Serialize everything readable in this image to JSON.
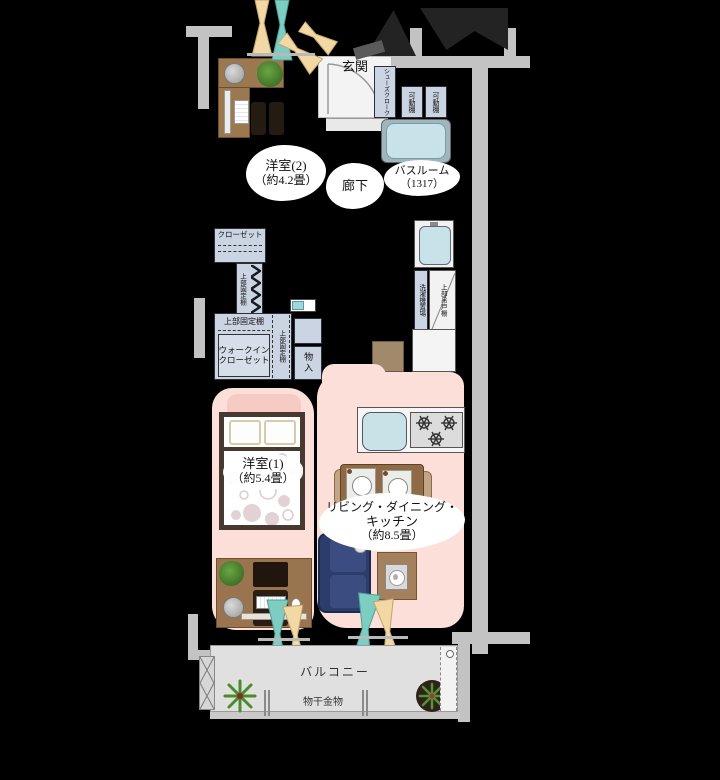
{
  "palette": {
    "background": "#000000",
    "wall_gray": "#C3C3C3",
    "floor_pink": "#FBDFD8",
    "balcony_gray": "#E0E0E0",
    "shelf_blue": "#CBD4E2",
    "bath_blue": "#C7E2E8",
    "wood_brown": "#9C7850",
    "sofa_navy": "#2C3C6C",
    "curtain_beige": "#F2D8A4",
    "curtain_teal": "#7ECDC3",
    "plant_green": "#4C8B2B"
  },
  "labels": {
    "genkan": "玄関",
    "shoes_cloak": "シューズクローク",
    "movable_shelf_1": "可動棚",
    "movable_shelf_2": "可動棚",
    "bathroom": "バスルーム",
    "bathroom_size": "（1317）",
    "western_room_2": "洋室(2)",
    "western_room_2_size": "（約4.2畳）",
    "hallway": "廊下",
    "closet": "クローゼット",
    "upper_fixed_shelf_closet": "上部固定棚",
    "upper_fixed_shelf_wic_top": "上部固定棚",
    "upper_fixed_shelf_wic_side": "上部固定棚",
    "walk_in_closet_line1": "ウォークイン",
    "walk_in_closet_line2": "クローゼット",
    "storage": "物入",
    "washer_space": "洗濯機置場",
    "upper_hanging_cupboard": "上部吊戸棚",
    "western_room_1": "洋室(1)",
    "western_room_1_size": "（約5.4畳）",
    "ldk_line1": "リビング・ダイニング・",
    "ldk_line2": "キッチン",
    "ldk_line3": "（約8.5畳）",
    "balcony": "バルコニー",
    "laundry_hardware": "物干金物"
  }
}
